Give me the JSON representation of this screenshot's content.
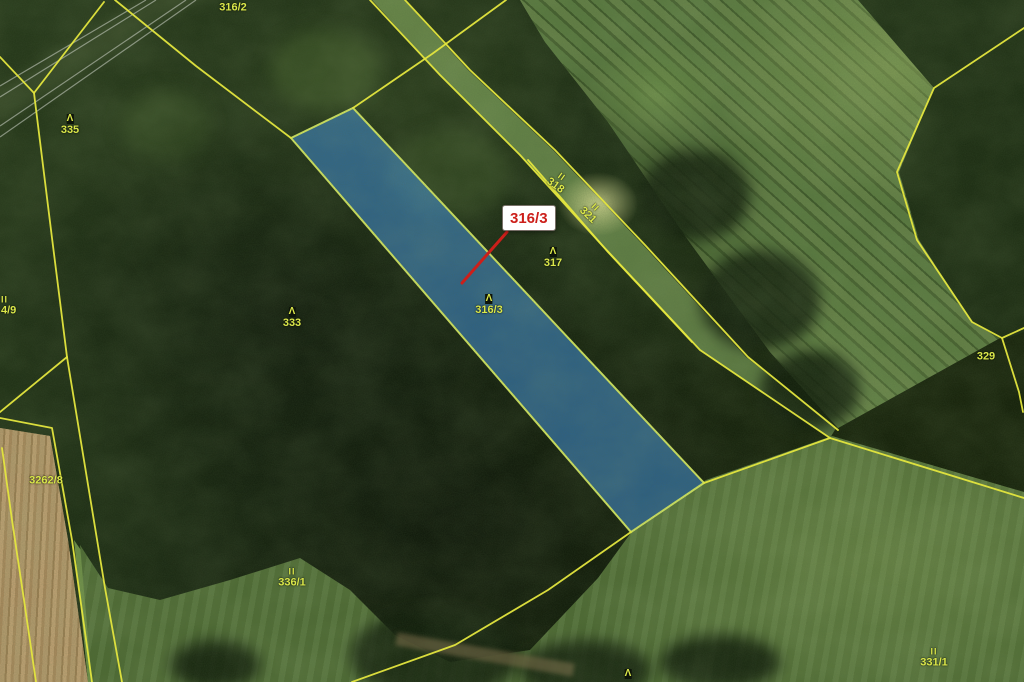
{
  "app": {
    "type": "cadastral-map-over-orthophoto"
  },
  "map": {
    "callout": {
      "text": "316/3"
    },
    "symbols": {
      "forest": "Λ",
      "grassland": "II"
    },
    "colors": {
      "boundary": "#e4e63e",
      "parcel_label": "#dbe84a",
      "highlight_fill": "#3f8ad2",
      "highlight_stroke": "#d6e960",
      "callout_text": "#cc1f1a",
      "callout_bg": "#ffffff"
    },
    "labels": [
      {
        "text": "316/2",
        "x": 233,
        "y": 8
      },
      {
        "text": "335",
        "x": 70,
        "y": 125,
        "symbol": "forest"
      },
      {
        "text": "318",
        "x": 558,
        "y": 182,
        "rot": 36,
        "symbol": "grassland"
      },
      {
        "text": "321",
        "x": 591,
        "y": 212,
        "rot": 44,
        "symbol": "grassland"
      },
      {
        "text": "317",
        "x": 553,
        "y": 258,
        "symbol": "forest"
      },
      {
        "text": "316/3",
        "x": 489,
        "y": 305,
        "symbol": "forest"
      },
      {
        "text": "333",
        "x": 292,
        "y": 318,
        "symbol": "forest"
      },
      {
        "text": "4/9",
        "x": 1,
        "y": 306,
        "symbol": "grassland",
        "align": "left"
      },
      {
        "text": "329",
        "x": 986,
        "y": 357
      },
      {
        "text": "3262/8",
        "x": 46,
        "y": 481
      },
      {
        "text": "336/1",
        "x": 292,
        "y": 578,
        "symbol": "grassland"
      },
      {
        "text": "331/1",
        "x": 934,
        "y": 658,
        "symbol": "grassland"
      },
      {
        "text": "",
        "x": 628,
        "y": 674,
        "symbol": "forest"
      }
    ]
  }
}
